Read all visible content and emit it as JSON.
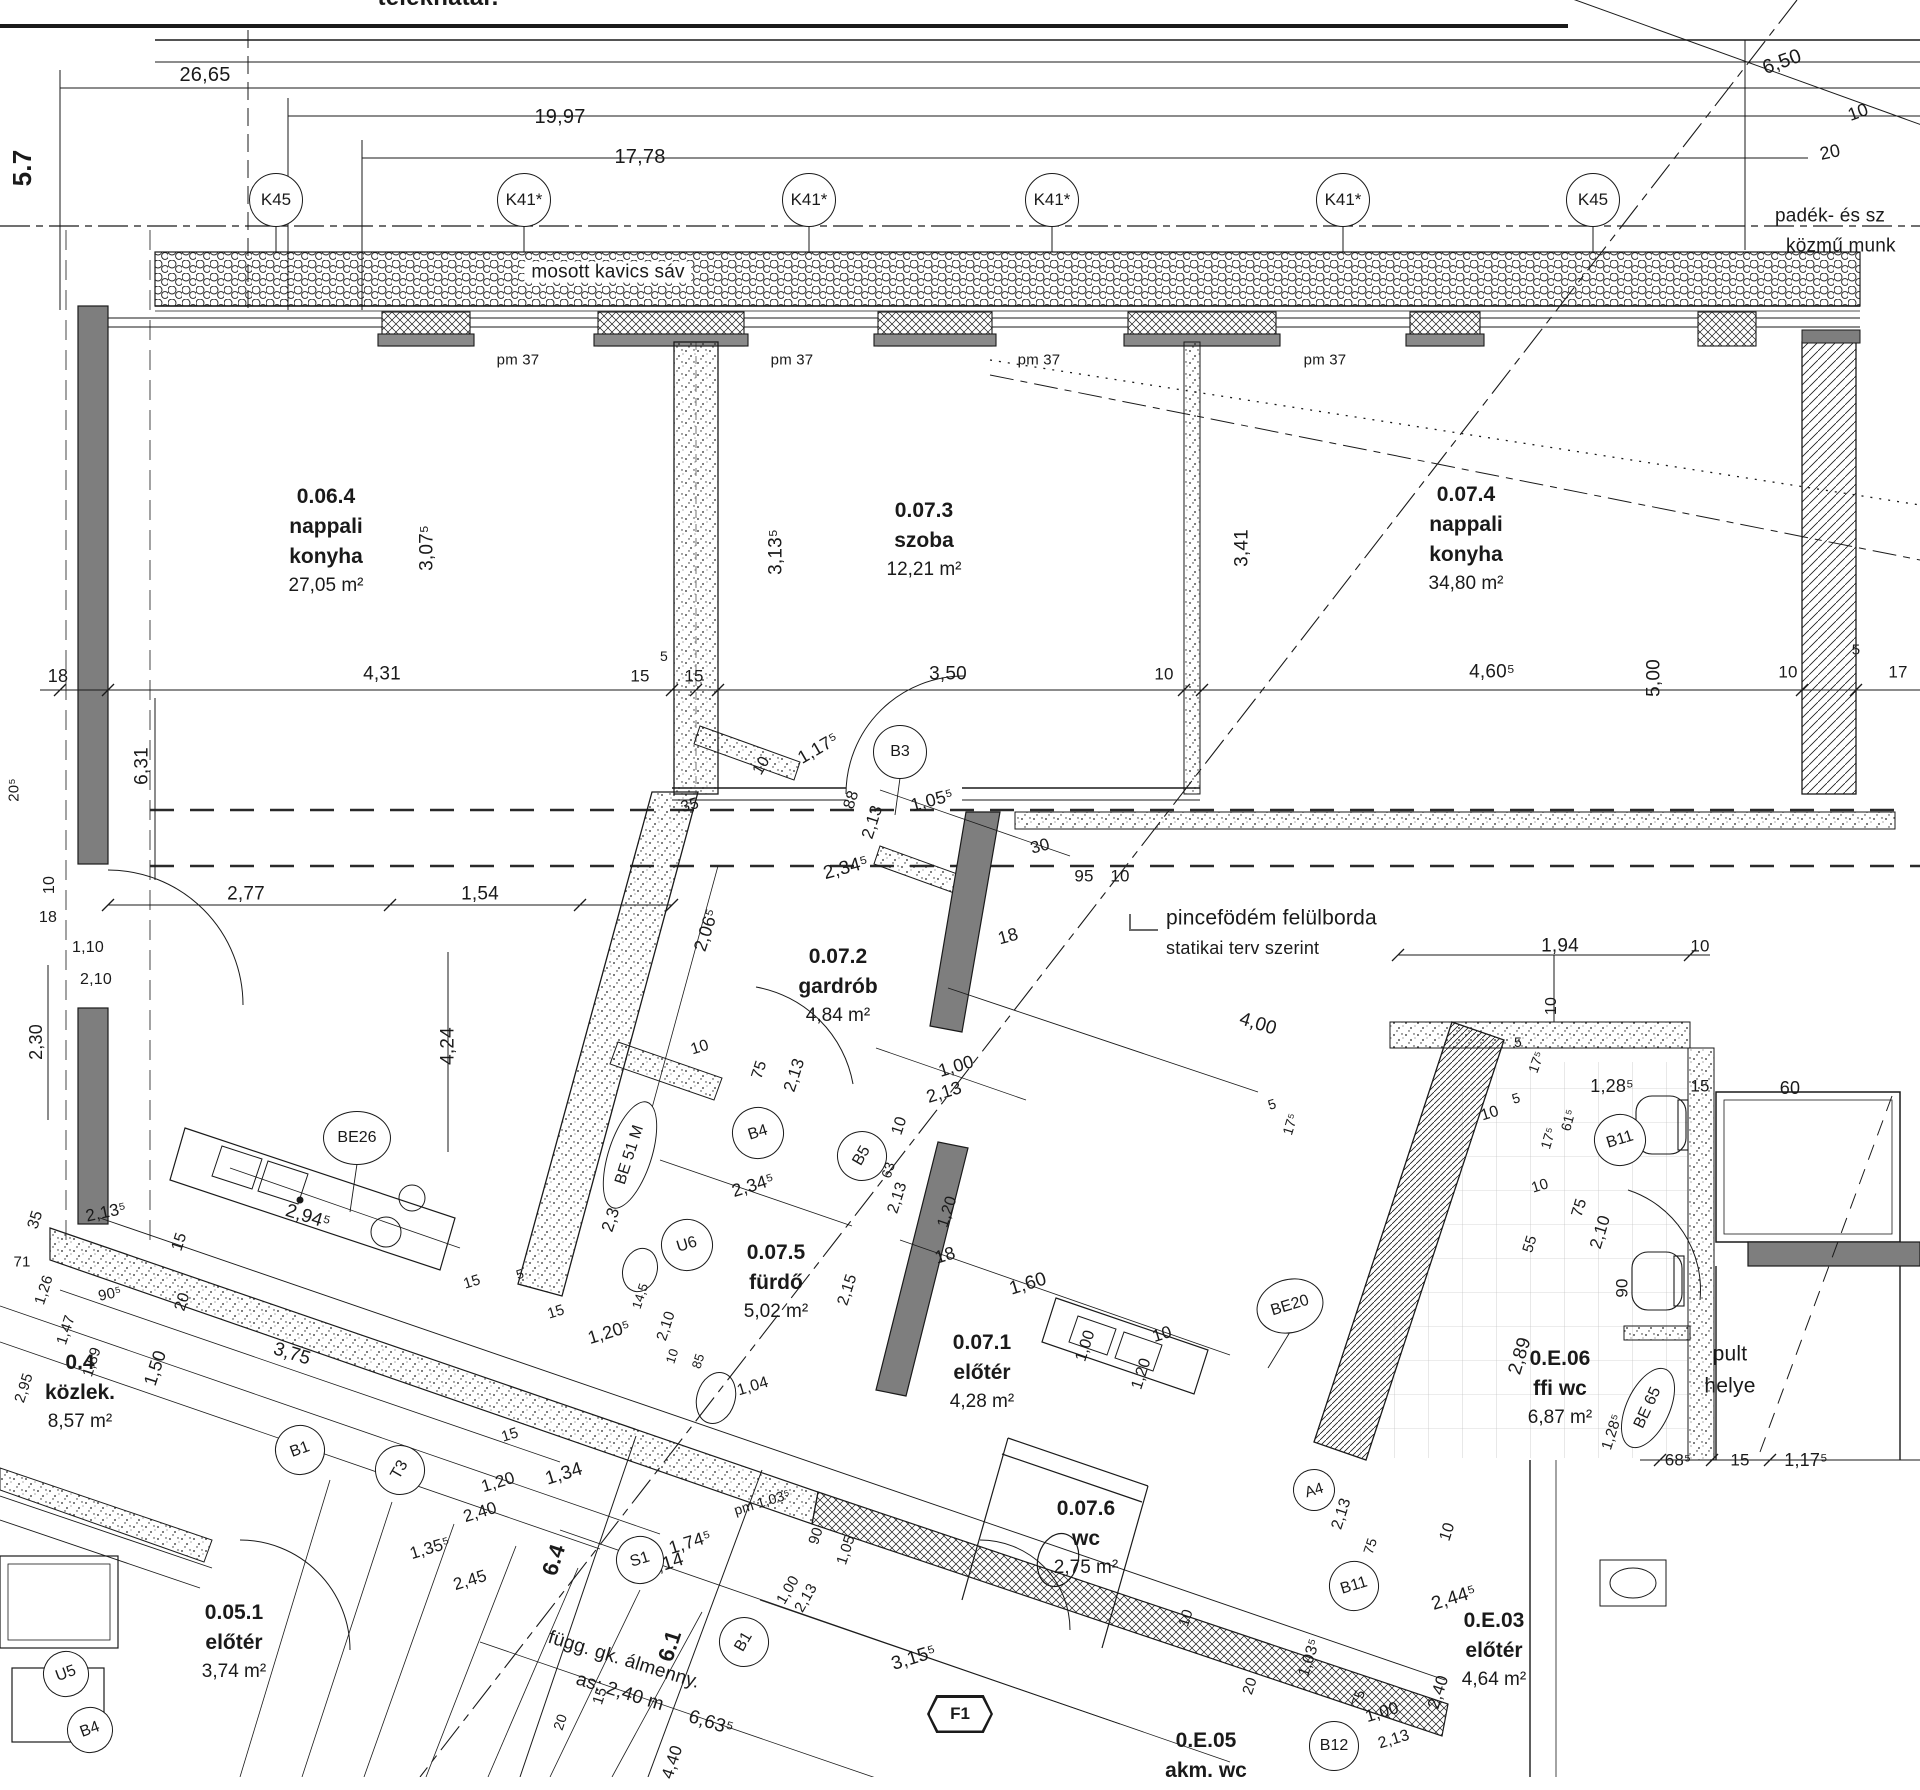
{
  "drawing": {
    "boundary_label": "telekhatár.",
    "ink": "#1a1a1a",
    "wall_grey": "#7e7e7e",
    "paper": "#ffffff"
  },
  "axis_bubbles": [
    {
      "t": "K45",
      "x": 276,
      "y": 200
    },
    {
      "t": "K41*",
      "x": 524,
      "y": 200
    },
    {
      "t": "K41*",
      "x": 809,
      "y": 200
    },
    {
      "t": "K41*",
      "x": 1052,
      "y": 200
    },
    {
      "t": "K41*",
      "x": 1343,
      "y": 200
    },
    {
      "t": "K45",
      "x": 1593,
      "y": 200
    }
  ],
  "rooms": [
    {
      "num": "0.06.4",
      "name": [
        "nappali",
        "konyha"
      ],
      "area": "27,05 m²",
      "x": 326,
      "y": 486
    },
    {
      "num": "0.07.3",
      "name": [
        "szoba"
      ],
      "area": "12,21 m²",
      "x": 924,
      "y": 500
    },
    {
      "num": "0.07.4",
      "name": [
        "nappali",
        "konyha"
      ],
      "area": "34,80 m²",
      "x": 1466,
      "y": 484
    },
    {
      "num": "0.07.2",
      "name": [
        "gardrób"
      ],
      "area": "4,84 m²",
      "x": 838,
      "y": 946
    },
    {
      "num": "0.07.5",
      "name": [
        "fürdő"
      ],
      "area": "5,02 m²",
      "x": 776,
      "y": 1242
    },
    {
      "num": "0.07.1",
      "name": [
        "előtér"
      ],
      "area": "4,28 m²",
      "x": 982,
      "y": 1332
    },
    {
      "num": "0.07.6",
      "name": [
        "wc"
      ],
      "area": "2,75 m²",
      "x": 1086,
      "y": 1498
    },
    {
      "num": "0.E.06",
      "name": [
        "ffi wc"
      ],
      "area": "6,87 m²",
      "x": 1560,
      "y": 1348
    },
    {
      "num": "0.4",
      "name": [
        "közlek."
      ],
      "area": "8,57 m²",
      "x": 80,
      "y": 1352
    },
    {
      "num": "0.05.1",
      "name": [
        "előtér"
      ],
      "area": "3,74 m²",
      "x": 234,
      "y": 1602
    },
    {
      "num": "0.E.03",
      "name": [
        "előtér"
      ],
      "area": "4,64 m²",
      "x": 1494,
      "y": 1610
    },
    {
      "num": "0.E.05",
      "name": [
        "akm. wc"
      ],
      "area": "",
      "x": 1206,
      "y": 1730
    }
  ],
  "markers": [
    {
      "t": "B3",
      "x": 900,
      "y": 752,
      "w": 52,
      "h": 52
    },
    {
      "t": "B4",
      "x": 758,
      "y": 1133,
      "w": 50,
      "h": 50,
      "r": -17
    },
    {
      "t": "U6",
      "x": 687,
      "y": 1245,
      "w": 50,
      "h": 50,
      "r": -17
    },
    {
      "t": "BE26",
      "x": 357,
      "y": 1138,
      "w": 66,
      "h": 52
    },
    {
      "t": "BE20",
      "x": 1290,
      "y": 1306,
      "w": 66,
      "h": 52,
      "r": -17
    },
    {
      "t": "B5",
      "x": 862,
      "y": 1156,
      "w": 48,
      "h": 48,
      "r": -60
    },
    {
      "t": "B1",
      "x": 744,
      "y": 1642,
      "w": 48,
      "h": 48,
      "r": -60
    },
    {
      "t": "B1",
      "x": 300,
      "y": 1450,
      "w": 48,
      "h": 48,
      "r": -20
    },
    {
      "t": "T3",
      "x": 400,
      "y": 1470,
      "w": 48,
      "h": 48,
      "r": -60
    },
    {
      "t": "S1",
      "x": 640,
      "y": 1560,
      "w": 46,
      "h": 46,
      "r": -17
    },
    {
      "t": "U5",
      "x": 66,
      "y": 1674,
      "w": 44,
      "h": 44,
      "r": -20
    },
    {
      "t": "B4",
      "x": 90,
      "y": 1730,
      "w": 44,
      "h": 44,
      "r": -20
    },
    {
      "t": "B11",
      "x": 1620,
      "y": 1140,
      "w": 50,
      "h": 50,
      "r": -17
    },
    {
      "t": "B11",
      "x": 1354,
      "y": 1586,
      "w": 48,
      "h": 48,
      "r": -17
    },
    {
      "t": "B12",
      "x": 1334,
      "y": 1746,
      "w": 48,
      "h": 48
    },
    {
      "t": "A4",
      "x": 1314,
      "y": 1490,
      "w": 40,
      "h": 40,
      "r": -17
    },
    {
      "t": "BE 65",
      "x": 1648,
      "y": 1408,
      "w": 84,
      "h": 42,
      "r": -65
    },
    {
      "t": "BE 51 M",
      "x": 630,
      "y": 1155,
      "w": 110,
      "h": 42,
      "r": -72
    }
  ],
  "hex_markers": [
    {
      "t": "F1",
      "x": 960,
      "y": 1714,
      "w": 66,
      "h": 38
    }
  ],
  "texts": [
    {
      "t": "telekhatár.",
      "x": 438,
      "y": -2,
      "s": 24,
      "b": true
    },
    {
      "t": "26,65",
      "x": 205,
      "y": 75,
      "s": 20
    },
    {
      "t": "19,97",
      "x": 560,
      "y": 117,
      "s": 20
    },
    {
      "t": "17,78",
      "x": 640,
      "y": 157,
      "s": 20
    },
    {
      "t": "5.7",
      "x": 22,
      "y": 168,
      "r": -90,
      "s": 26,
      "b": true
    },
    {
      "t": "6,50",
      "x": 1782,
      "y": 62,
      "r": -20,
      "s": 20
    },
    {
      "t": "10",
      "x": 1858,
      "y": 112,
      "r": -20,
      "s": 18
    },
    {
      "t": "20",
      "x": 1830,
      "y": 152,
      "r": -12,
      "s": 18
    },
    {
      "t": "padék- és sz",
      "x": 1775,
      "y": 216,
      "s": 19,
      "a": "l"
    },
    {
      "t": "közmű munk",
      "x": 1786,
      "y": 246,
      "s": 19,
      "a": "l"
    },
    {
      "t": "mosott kavics sáv",
      "x": 608,
      "y": 272,
      "s": 19,
      "bg": true
    },
    {
      "t": "pm 37",
      "x": 518,
      "y": 360,
      "s": 15
    },
    {
      "t": "pm 37",
      "x": 792,
      "y": 360,
      "s": 15
    },
    {
      "t": "pm 37",
      "x": 1039,
      "y": 360,
      "s": 15
    },
    {
      "t": "pm 37",
      "x": 1325,
      "y": 360,
      "s": 15
    },
    {
      "t": "3,07⁵",
      "x": 427,
      "y": 548,
      "r": -90,
      "s": 19
    },
    {
      "t": "3,13⁵",
      "x": 776,
      "y": 552,
      "r": -90,
      "s": 19
    },
    {
      "t": "3,41",
      "x": 1242,
      "y": 548,
      "r": -90,
      "s": 19
    },
    {
      "t": "18",
      "x": 58,
      "y": 676,
      "s": 18
    },
    {
      "t": "4,31",
      "x": 382,
      "y": 674,
      "s": 19
    },
    {
      "t": "15",
      "x": 640,
      "y": 676,
      "s": 17
    },
    {
      "t": "5",
      "x": 664,
      "y": 656,
      "s": 14
    },
    {
      "t": "15",
      "x": 694,
      "y": 676,
      "s": 17
    },
    {
      "t": "3,50",
      "x": 948,
      "y": 674,
      "s": 19
    },
    {
      "t": "10",
      "x": 1164,
      "y": 674,
      "s": 17
    },
    {
      "t": "4,60⁵",
      "x": 1492,
      "y": 672,
      "s": 19
    },
    {
      "t": "5,00",
      "x": 1654,
      "y": 678,
      "r": -90,
      "s": 19
    },
    {
      "t": "10",
      "x": 1788,
      "y": 672,
      "s": 17
    },
    {
      "t": "5",
      "x": 1856,
      "y": 650,
      "s": 15
    },
    {
      "t": "17",
      "x": 1898,
      "y": 672,
      "s": 17
    },
    {
      "t": "6,31",
      "x": 142,
      "y": 766,
      "r": -90,
      "s": 19
    },
    {
      "t": "20⁵",
      "x": 14,
      "y": 790,
      "r": -90,
      "s": 15
    },
    {
      "t": "10",
      "x": 50,
      "y": 885,
      "r": -90,
      "s": 16
    },
    {
      "t": "18",
      "x": 48,
      "y": 918,
      "s": 16
    },
    {
      "t": "1,10",
      "x": 88,
      "y": 948,
      "s": 16
    },
    {
      "t": "2,10",
      "x": 96,
      "y": 980,
      "s": 16
    },
    {
      "t": "2,77",
      "x": 246,
      "y": 894,
      "s": 19
    },
    {
      "t": "1,54",
      "x": 480,
      "y": 894,
      "s": 19
    },
    {
      "t": "2,30",
      "x": 36,
      "y": 1042,
      "r": -90,
      "s": 18
    },
    {
      "t": "4,24",
      "x": 448,
      "y": 1046,
      "r": -90,
      "s": 19
    },
    {
      "t": "1,17⁵",
      "x": 818,
      "y": 748,
      "r": -30,
      "s": 18
    },
    {
      "t": "10",
      "x": 762,
      "y": 766,
      "r": -60,
      "s": 16
    },
    {
      "t": "88",
      "x": 852,
      "y": 800,
      "r": -72,
      "s": 16
    },
    {
      "t": "2,13",
      "x": 872,
      "y": 822,
      "r": -72,
      "s": 17
    },
    {
      "t": "1,05⁵",
      "x": 932,
      "y": 800,
      "r": -15,
      "s": 18
    },
    {
      "t": "30",
      "x": 1040,
      "y": 846,
      "r": -15,
      "s": 17
    },
    {
      "t": "2,34⁵",
      "x": 846,
      "y": 868,
      "r": -15,
      "s": 19
    },
    {
      "t": "2,06⁵",
      "x": 706,
      "y": 930,
      "r": -72,
      "s": 18
    },
    {
      "t": "35",
      "x": 690,
      "y": 806,
      "r": -15,
      "s": 16
    },
    {
      "t": "95",
      "x": 1084,
      "y": 876,
      "s": 17
    },
    {
      "t": "10",
      "x": 1120,
      "y": 876,
      "s": 17
    },
    {
      "t": "18",
      "x": 1008,
      "y": 936,
      "r": -15,
      "s": 18
    },
    {
      "t": "4,00",
      "x": 1258,
      "y": 1024,
      "r": 17,
      "s": 19
    },
    {
      "t": "1,00",
      "x": 956,
      "y": 1066,
      "r": -17,
      "s": 18
    },
    {
      "t": "2,13",
      "x": 944,
      "y": 1092,
      "r": -17,
      "s": 18
    },
    {
      "t": "10",
      "x": 900,
      "y": 1126,
      "r": -72,
      "s": 16
    },
    {
      "t": "pincefödém felülborda",
      "x": 1166,
      "y": 918,
      "s": 21,
      "a": "l"
    },
    {
      "t": "statikai terv szerint",
      "x": 1166,
      "y": 948,
      "s": 18,
      "a": "l"
    },
    {
      "t": "1,94",
      "x": 1560,
      "y": 946,
      "s": 19
    },
    {
      "t": "10",
      "x": 1700,
      "y": 946,
      "s": 17
    },
    {
      "t": "10",
      "x": 1552,
      "y": 1006,
      "r": -90,
      "s": 16
    },
    {
      "t": "5",
      "x": 1518,
      "y": 1042,
      "s": 14
    },
    {
      "t": "17⁵",
      "x": 1536,
      "y": 1062,
      "r": -70,
      "s": 14
    },
    {
      "t": "5",
      "x": 1272,
      "y": 1104,
      "r": -17,
      "s": 14
    },
    {
      "t": "17⁵",
      "x": 1290,
      "y": 1124,
      "r": -73,
      "s": 14
    },
    {
      "t": "1,28⁵",
      "x": 1612,
      "y": 1086,
      "s": 18
    },
    {
      "t": "15",
      "x": 1700,
      "y": 1086,
      "s": 17
    },
    {
      "t": "60",
      "x": 1790,
      "y": 1088,
      "s": 18
    },
    {
      "t": "90",
      "x": 1622,
      "y": 1130,
      "r": -90,
      "s": 17
    },
    {
      "t": "90",
      "x": 1622,
      "y": 1288,
      "r": -90,
      "s": 17
    },
    {
      "t": "75",
      "x": 1580,
      "y": 1208,
      "r": -73,
      "s": 16
    },
    {
      "t": "2,10",
      "x": 1600,
      "y": 1232,
      "r": -73,
      "s": 17
    },
    {
      "t": "10",
      "x": 1540,
      "y": 1186,
      "r": -17,
      "s": 15
    },
    {
      "t": "55",
      "x": 1530,
      "y": 1244,
      "r": -73,
      "s": 15
    },
    {
      "t": "61⁵",
      "x": 1568,
      "y": 1120,
      "r": -75,
      "s": 14
    },
    {
      "t": "17⁵",
      "x": 1548,
      "y": 1138,
      "r": -73,
      "s": 14
    },
    {
      "t": "10",
      "x": 1490,
      "y": 1114,
      "r": -17,
      "s": 16
    },
    {
      "t": "5",
      "x": 1516,
      "y": 1098,
      "r": -17,
      "s": 14
    },
    {
      "t": "2,89",
      "x": 1520,
      "y": 1356,
      "r": -73,
      "s": 19
    },
    {
      "t": "pult",
      "x": 1730,
      "y": 1354,
      "s": 21
    },
    {
      "t": "helye",
      "x": 1730,
      "y": 1386,
      "s": 21
    },
    {
      "t": "1,28⁵",
      "x": 1612,
      "y": 1432,
      "r": -72,
      "s": 15
    },
    {
      "t": "68⁵",
      "x": 1678,
      "y": 1460,
      "s": 17
    },
    {
      "t": "15",
      "x": 1740,
      "y": 1460,
      "s": 17
    },
    {
      "t": "1,17⁵",
      "x": 1806,
      "y": 1460,
      "s": 18
    },
    {
      "t": "10",
      "x": 700,
      "y": 1048,
      "r": -17,
      "s": 16
    },
    {
      "t": "75",
      "x": 760,
      "y": 1070,
      "r": -72,
      "s": 16
    },
    {
      "t": "2,13",
      "x": 794,
      "y": 1075,
      "r": -72,
      "s": 17
    },
    {
      "t": "2,34⁵",
      "x": 753,
      "y": 1185,
      "r": -17,
      "s": 18
    },
    {
      "t": "2,30",
      "x": 612,
      "y": 1215,
      "r": -72,
      "s": 17
    },
    {
      "t": "15",
      "x": 472,
      "y": 1282,
      "r": -17,
      "s": 15
    },
    {
      "t": "5",
      "x": 520,
      "y": 1274,
      "r": -17,
      "s": 13
    },
    {
      "t": "15",
      "x": 556,
      "y": 1312,
      "r": -17,
      "s": 15
    },
    {
      "t": "1,20⁵",
      "x": 609,
      "y": 1332,
      "r": -17,
      "s": 18
    },
    {
      "t": "14,5",
      "x": 640,
      "y": 1296,
      "r": -72,
      "s": 13
    },
    {
      "t": "2,10",
      "x": 666,
      "y": 1326,
      "r": -72,
      "s": 15
    },
    {
      "t": "10",
      "x": 672,
      "y": 1356,
      "r": -72,
      "s": 13
    },
    {
      "t": "85",
      "x": 698,
      "y": 1361,
      "r": -72,
      "s": 13
    },
    {
      "t": "1,04",
      "x": 753,
      "y": 1387,
      "r": -17,
      "s": 16
    },
    {
      "t": "15",
      "x": 510,
      "y": 1435,
      "r": -17,
      "s": 15
    },
    {
      "t": "1,20",
      "x": 498,
      "y": 1482,
      "r": -17,
      "s": 17
    },
    {
      "t": "2,40",
      "x": 480,
      "y": 1512,
      "r": -17,
      "s": 17
    },
    {
      "t": "pm 1,03⁵",
      "x": 762,
      "y": 1502,
      "r": -17,
      "s": 14
    },
    {
      "t": "1,34",
      "x": 564,
      "y": 1474,
      "r": -17,
      "s": 19
    },
    {
      "t": "90",
      "x": 816,
      "y": 1536,
      "r": -72,
      "s": 15
    },
    {
      "t": "1,05",
      "x": 846,
      "y": 1550,
      "r": -72,
      "s": 15
    },
    {
      "t": "15",
      "x": 600,
      "y": 1696,
      "r": -72,
      "s": 15
    },
    {
      "t": "20",
      "x": 560,
      "y": 1722,
      "r": -72,
      "s": 14
    },
    {
      "t": "18",
      "x": 945,
      "y": 1255,
      "r": -17,
      "s": 18
    },
    {
      "t": "1,60",
      "x": 1028,
      "y": 1284,
      "r": -17,
      "s": 19
    },
    {
      "t": "2,15",
      "x": 848,
      "y": 1290,
      "r": -72,
      "s": 16
    },
    {
      "t": "10",
      "x": 1162,
      "y": 1334,
      "r": -17,
      "s": 17
    },
    {
      "t": "63",
      "x": 888,
      "y": 1170,
      "r": -72,
      "s": 14
    },
    {
      "t": "2,13",
      "x": 898,
      "y": 1198,
      "r": -72,
      "s": 16
    },
    {
      "t": "1,20",
      "x": 948,
      "y": 1212,
      "r": -72,
      "s": 16
    },
    {
      "t": "1,00",
      "x": 1086,
      "y": 1346,
      "r": -72,
      "s": 16
    },
    {
      "t": "1,20",
      "x": 1142,
      "y": 1374,
      "r": -72,
      "s": 16
    },
    {
      "t": "10",
      "x": 1186,
      "y": 1618,
      "r": -72,
      "s": 15
    },
    {
      "t": "20",
      "x": 1250,
      "y": 1686,
      "r": -72,
      "s": 15
    },
    {
      "t": "1,03⁵",
      "x": 1310,
      "y": 1658,
      "r": -72,
      "s": 16
    },
    {
      "t": "75",
      "x": 1358,
      "y": 1698,
      "r": -72,
      "s": 14
    },
    {
      "t": "3,15⁵",
      "x": 914,
      "y": 1658,
      "r": -17,
      "s": 19
    },
    {
      "t": "2,13",
      "x": 1342,
      "y": 1514,
      "r": -72,
      "s": 16
    },
    {
      "t": "75",
      "x": 1370,
      "y": 1546,
      "r": -72,
      "s": 14
    },
    {
      "t": "1,00",
      "x": 1382,
      "y": 1712,
      "r": -17,
      "s": 17
    },
    {
      "t": "2,13",
      "x": 1394,
      "y": 1740,
      "r": -17,
      "s": 16
    },
    {
      "t": "2,44⁵",
      "x": 1454,
      "y": 1598,
      "r": -17,
      "s": 19
    },
    {
      "t": "2,40",
      "x": 1438,
      "y": 1692,
      "r": -72,
      "s": 17
    },
    {
      "t": "10",
      "x": 1448,
      "y": 1532,
      "r": -72,
      "s": 16
    },
    {
      "t": "2,13⁵",
      "x": 106,
      "y": 1212,
      "r": -12,
      "s": 17
    },
    {
      "t": "71",
      "x": 22,
      "y": 1262,
      "s": 15
    },
    {
      "t": "1,26",
      "x": 44,
      "y": 1290,
      "r": -72,
      "s": 15
    },
    {
      "t": "90⁵",
      "x": 110,
      "y": 1294,
      "r": -12,
      "s": 15
    },
    {
      "t": "1,47",
      "x": 66,
      "y": 1330,
      "r": -72,
      "s": 15
    },
    {
      "t": "1,89",
      "x": 92,
      "y": 1362,
      "r": -72,
      "s": 15
    },
    {
      "t": "2,95",
      "x": 24,
      "y": 1388,
      "r": -72,
      "s": 15
    },
    {
      "t": "1,50",
      "x": 155,
      "y": 1368,
      "r": -72,
      "s": 18
    },
    {
      "t": "20",
      "x": 183,
      "y": 1302,
      "r": -72,
      "s": 16
    },
    {
      "t": "15",
      "x": 180,
      "y": 1242,
      "r": -72,
      "s": 16
    },
    {
      "t": "3,75",
      "x": 292,
      "y": 1354,
      "r": 17,
      "s": 19
    },
    {
      "t": "2,94⁵",
      "x": 308,
      "y": 1217,
      "r": 17,
      "s": 19
    },
    {
      "t": "35",
      "x": 36,
      "y": 1220,
      "r": -72,
      "s": 16
    },
    {
      "t": "1,35⁵",
      "x": 430,
      "y": 1548,
      "r": -17,
      "s": 17
    },
    {
      "t": "2,45",
      "x": 470,
      "y": 1580,
      "r": -17,
      "s": 17
    },
    {
      "t": "1,74⁵",
      "x": 690,
      "y": 1542,
      "r": -17,
      "s": 18
    },
    {
      "t": "10,14",
      "x": 660,
      "y": 1566,
      "r": -17,
      "s": 19
    },
    {
      "t": "6,63⁵",
      "x": 711,
      "y": 1723,
      "r": 17,
      "s": 19
    },
    {
      "t": "4,40",
      "x": 672,
      "y": 1762,
      "r": -72,
      "s": 17
    },
    {
      "t": "1,00",
      "x": 788,
      "y": 1590,
      "r": -60,
      "s": 15
    },
    {
      "t": "2,13",
      "x": 806,
      "y": 1598,
      "r": -60,
      "s": 15
    },
    {
      "t": "6.4",
      "x": 554,
      "y": 1560,
      "r": -72,
      "s": 22,
      "b": true
    },
    {
      "t": "6.1",
      "x": 670,
      "y": 1646,
      "r": -72,
      "s": 22,
      "b": true
    },
    {
      "t": "függ. gk. álmenny.",
      "x": 624,
      "y": 1660,
      "r": 17,
      "s": 19
    },
    {
      "t": "as: 2,40 m",
      "x": 620,
      "y": 1692,
      "r": 17,
      "s": 19
    }
  ]
}
